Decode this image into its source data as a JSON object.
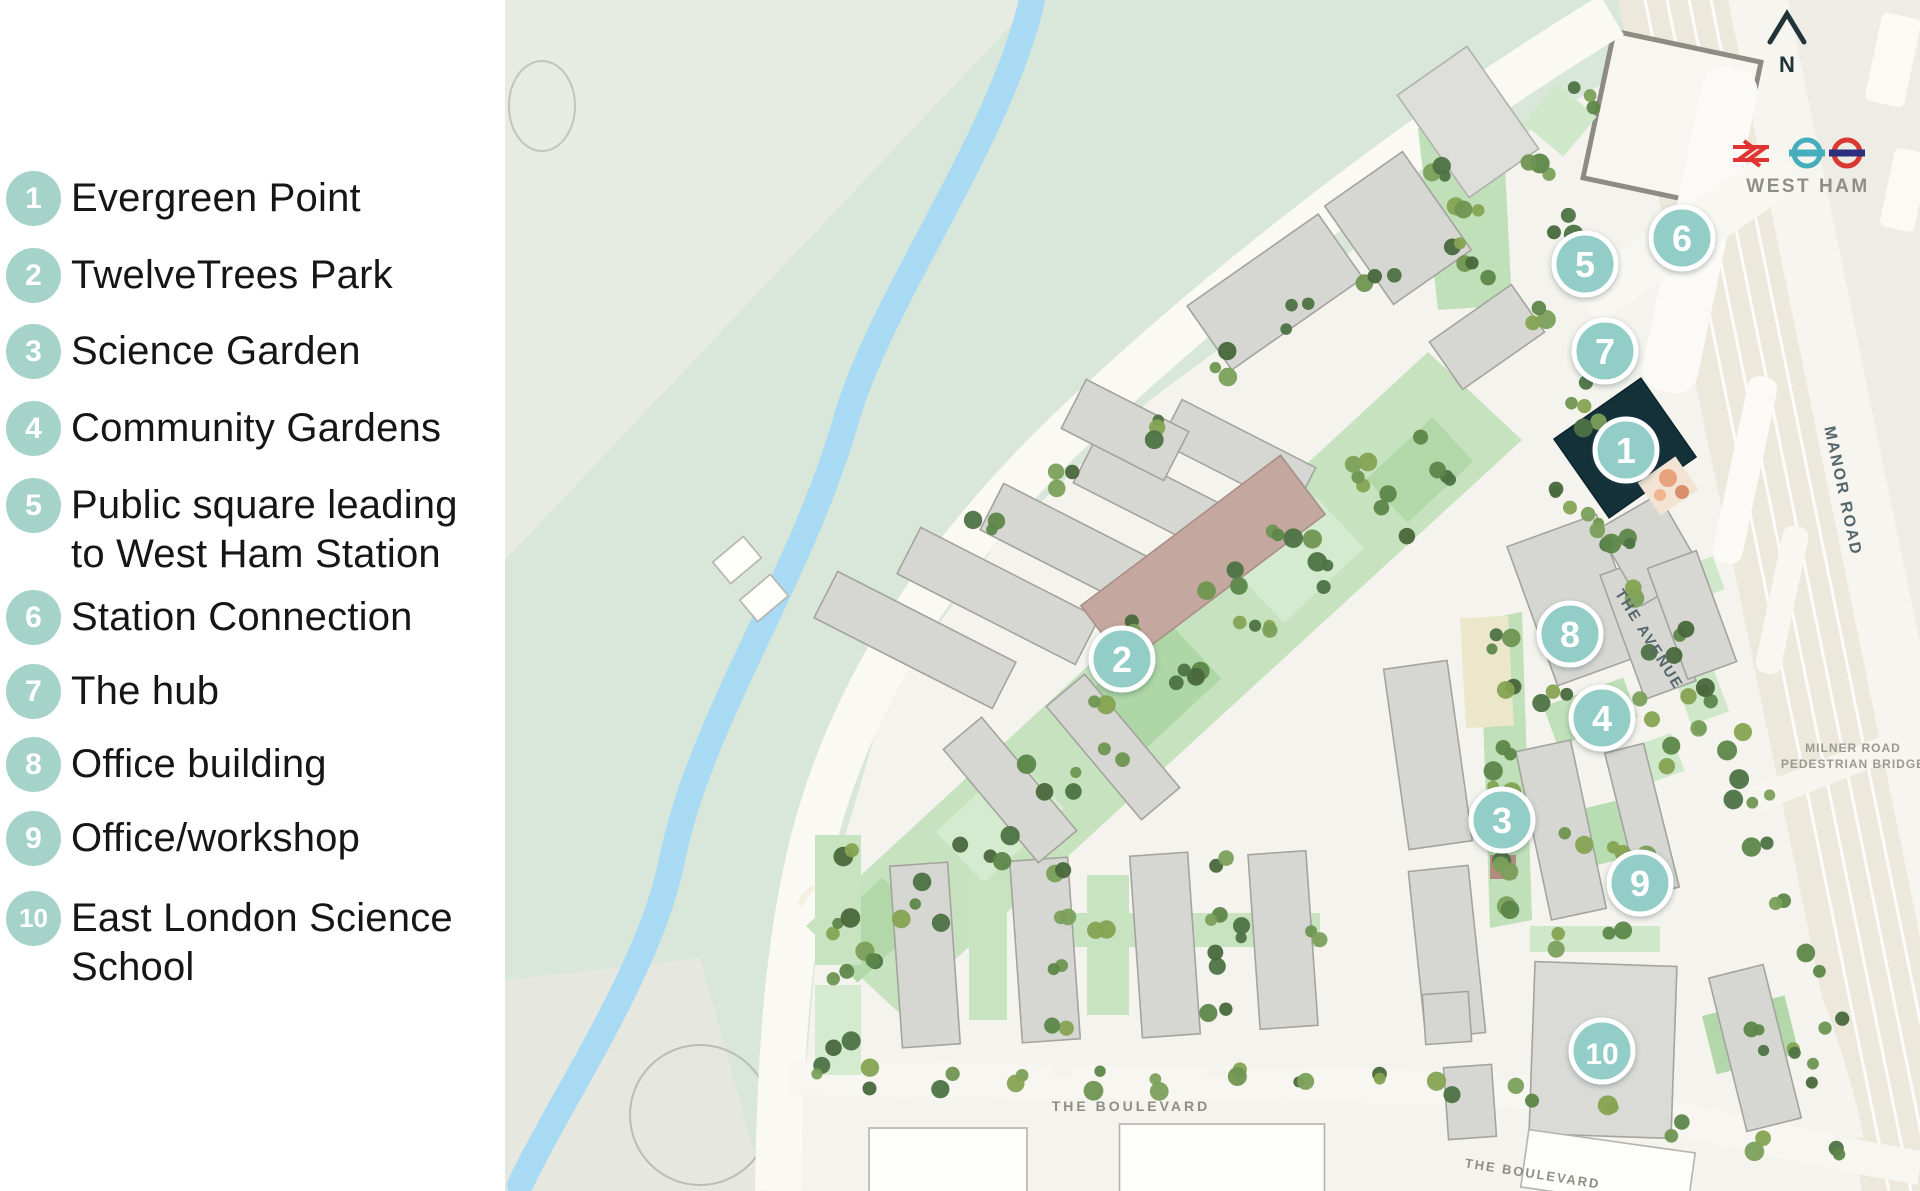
{
  "legend": {
    "items": [
      {
        "number": "1",
        "label": "Evergreen Point"
      },
      {
        "number": "2",
        "label": "TwelveTrees Park"
      },
      {
        "number": "3",
        "label": "Science Garden"
      },
      {
        "number": "4",
        "label": "Community Gardens"
      },
      {
        "number": "5",
        "label": "Public square leading to West Ham Station"
      },
      {
        "number": "6",
        "label": "Station Connection"
      },
      {
        "number": "7",
        "label": "The hub"
      },
      {
        "number": "8",
        "label": "Office building"
      },
      {
        "number": "9",
        "label": "Office/workshop"
      },
      {
        "number": "10",
        "label": "East London Science School"
      }
    ]
  },
  "map": {
    "markers": [
      {
        "number": "1"
      },
      {
        "number": "2"
      },
      {
        "number": "3"
      },
      {
        "number": "4"
      },
      {
        "number": "5"
      },
      {
        "number": "6"
      },
      {
        "number": "7"
      },
      {
        "number": "8"
      },
      {
        "number": "9"
      },
      {
        "number": "10"
      }
    ],
    "labels": {
      "west_ham": "WEST HAM",
      "manor_road": "MANOR ROAD",
      "the_avenue": "THE AVENUE",
      "milner_line1": "MILNER ROAD",
      "milner_line2": "PEDESTRIAN BRIDGE",
      "boulevard_west": "THE BOULEVARD",
      "boulevard_east": "THE BOULEVARD",
      "north": "N"
    },
    "colors": {
      "legend_circle": "#a6d3c9",
      "map_marker": "#93cdc8",
      "park": "#d9e6da",
      "river": "#a9daf3",
      "linear_park": "#c6e2bf",
      "building_grey": "#d6d7d2",
      "building_brown": "#c4a79e",
      "building_dark": "#14313a",
      "railway_beige": "#ece9dc",
      "national_rail_red": "#e03433",
      "roundel_teal": "#45aebc",
      "roundel_red": "#dc3832",
      "roundel_blue": "#2b2f7e"
    }
  }
}
